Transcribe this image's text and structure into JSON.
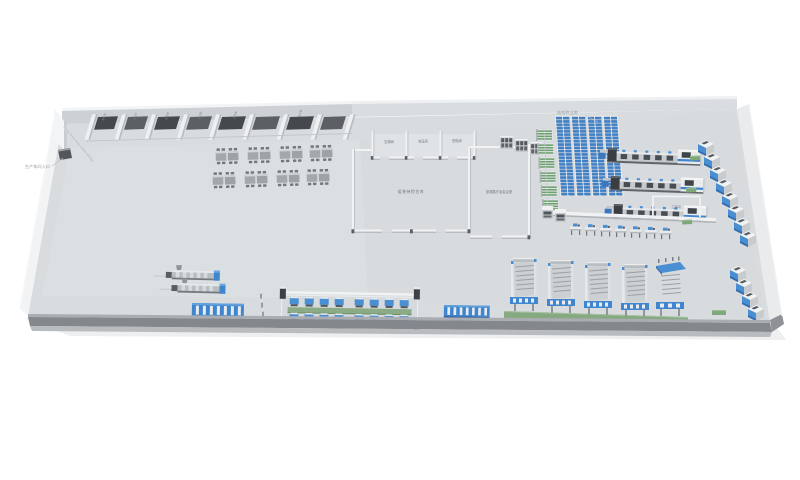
{
  "annotations": {
    "entrance": "生产车间入口",
    "asrs": "结构件立库"
  },
  "rooms": {
    "utility": [
      "空调间",
      "空压间",
      "配电间"
    ],
    "warehouse": "组装待检仓库",
    "exhibition": "参观展厅及会议室",
    "tool": "工具间",
    "top_row": [
      "更衣室",
      "卫生间",
      "休息室",
      "办公室",
      "资料室",
      "备件室"
    ]
  },
  "colors": {
    "accent_blue": "#3f86cf",
    "rack_blue": "#3e82cc",
    "conveyor_green": "#8aab85",
    "floor": "#d8dcdf",
    "front_wall": "#84888c"
  }
}
